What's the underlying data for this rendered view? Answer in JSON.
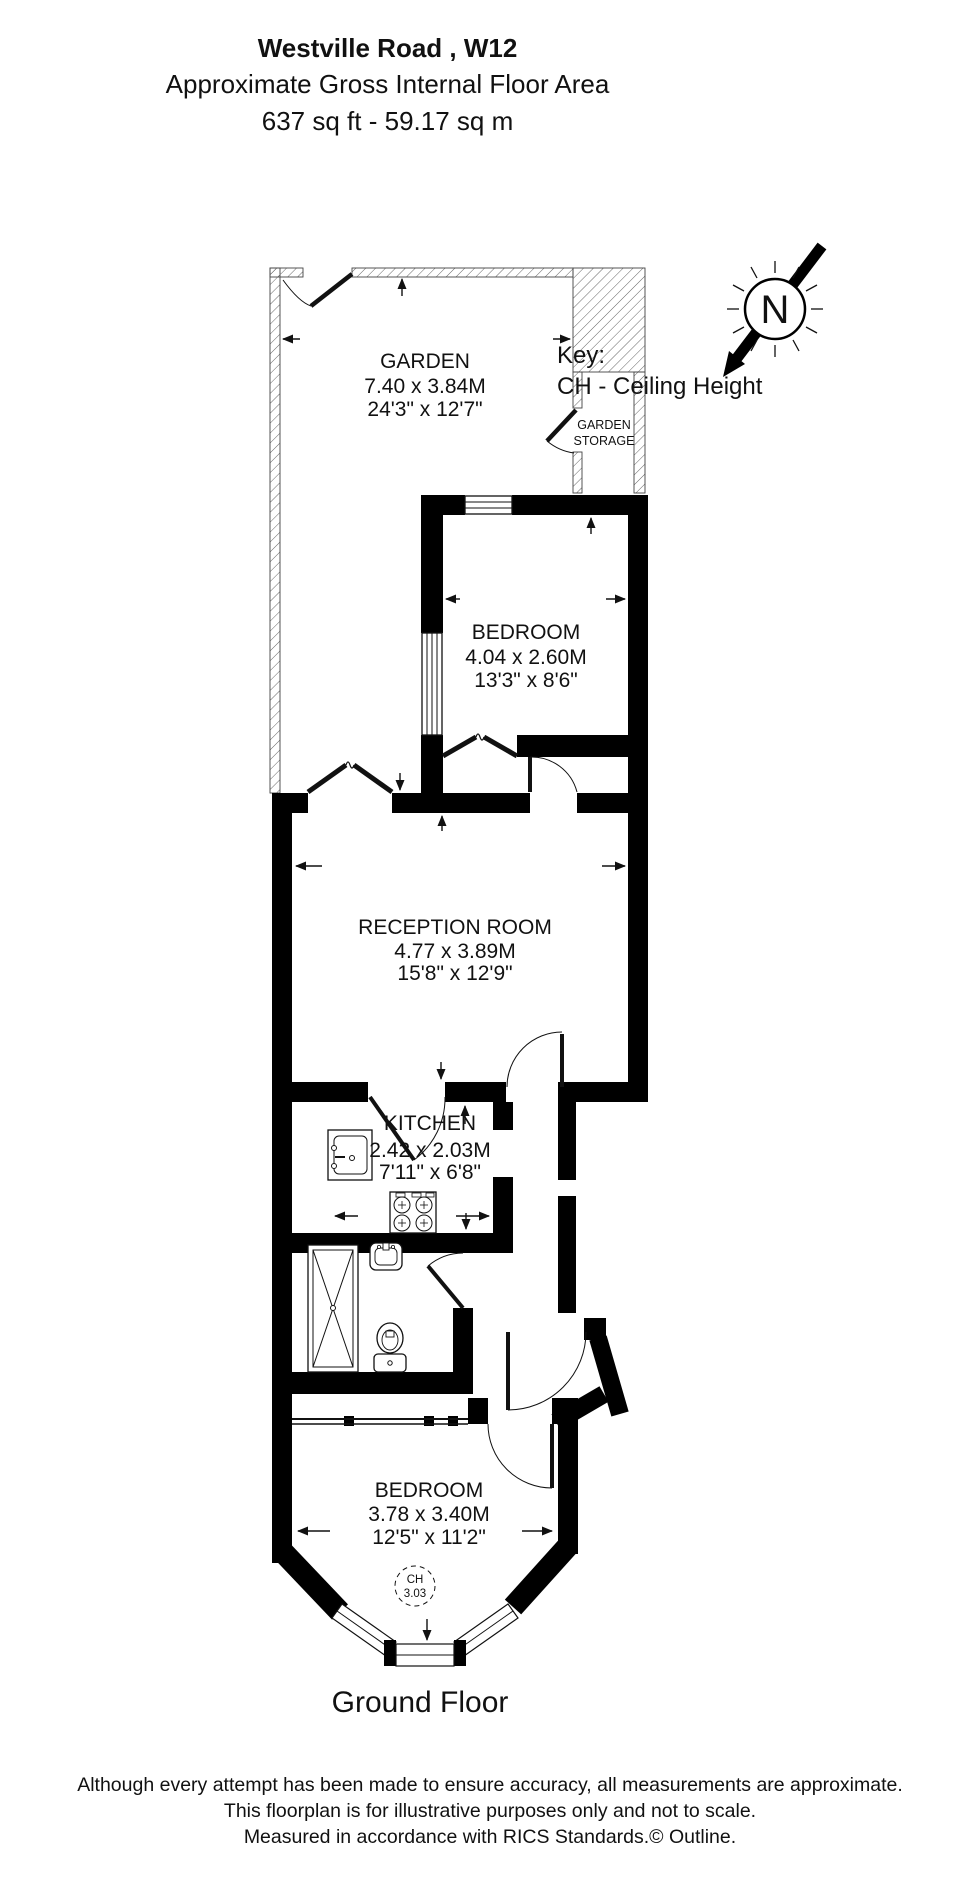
{
  "header": {
    "title": "Westville Road , W12",
    "subtitle": "Approximate Gross Internal Floor Area",
    "area": "637 sq ft - 59.17 sq m"
  },
  "key": {
    "label": "Key:",
    "entry": "CH - Ceiling Height"
  },
  "compass": {
    "letter": "N"
  },
  "rooms": {
    "garden": {
      "name": "GARDEN",
      "metric": "7.40 x 3.84M",
      "imperial": "24'3\" x 12'7\""
    },
    "garden_storage": {
      "line1": "GARDEN",
      "line2": "STORAGE"
    },
    "bedroom_rear": {
      "name": "BEDROOM",
      "metric": "4.04 x 2.60M",
      "imperial": "13'3\" x 8'6\""
    },
    "reception": {
      "name": "RECEPTION ROOM",
      "metric": "4.77 x 3.89M",
      "imperial": "15'8\" x 12'9\""
    },
    "kitchen": {
      "name": "KITCHEN",
      "metric": "2.42 x 2.03M",
      "imperial": "7'11\" x 6'8\""
    },
    "bedroom_front": {
      "name": "BEDROOM",
      "metric": "3.78 x 3.40M",
      "imperial": "12'5\" x 11'2\""
    }
  },
  "ceiling_height": {
    "label": "CH",
    "value": "3.03"
  },
  "floor_label": "Ground Floor",
  "footer": {
    "line1": "Although every attempt has been made to ensure accuracy, all measurements are approximate.",
    "line2": "This floorplan is for illustrative purposes only and not to scale.",
    "line3": "Measured in accordance with RICS Standards.© Outline."
  }
}
